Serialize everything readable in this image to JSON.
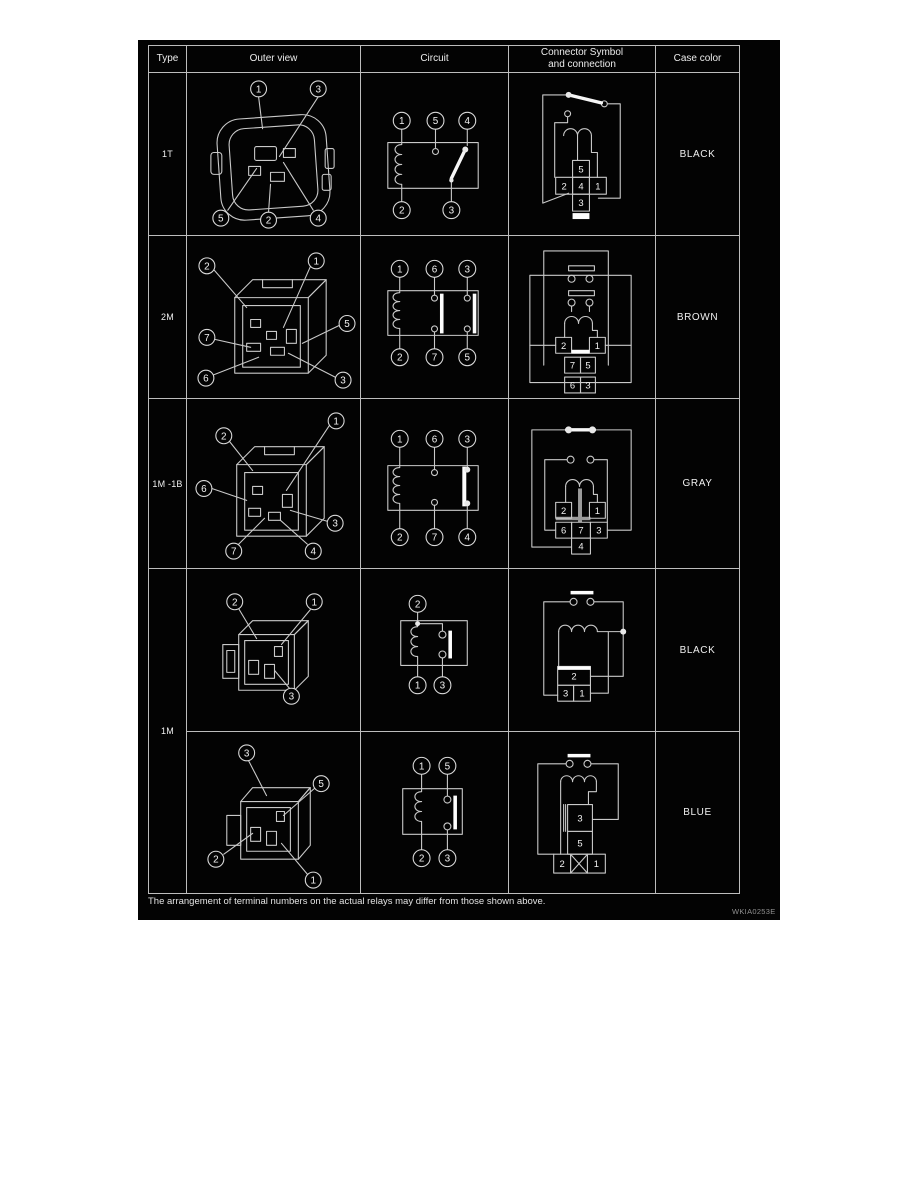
{
  "header": {
    "type": "Type",
    "outer_view": "Outer view",
    "circuit": "Circuit",
    "connector_line1": "Connector Symbol",
    "connector_line2": "and connection",
    "case_color": "Case color"
  },
  "rows": {
    "r1": {
      "type": "1T",
      "case_color": "BLACK",
      "outer": {
        "c1": "1",
        "c2": "3",
        "c3": "5",
        "c4": "2",
        "c5": "4"
      },
      "circuit": {
        "t1": "1",
        "t2": "5",
        "t3": "4",
        "b1": "2",
        "b2": "3"
      },
      "grid": {
        "top": "5",
        "m1": "2",
        "m2": "4",
        "m3": "1",
        "bottom": "3"
      }
    },
    "r2": {
      "type": "2M",
      "case_color": "BROWN",
      "outer": {
        "c1": "2",
        "c2": "1",
        "c3": "7",
        "c4": "5",
        "c5": "6",
        "c6": "3"
      },
      "circuit": {
        "t1": "1",
        "t2": "6",
        "t3": "3",
        "b1": "2",
        "b2": "7",
        "b3": "5"
      },
      "grid": {
        "a1": "2",
        "a2": "1",
        "b1": "7",
        "b2": "5",
        "c1": "6",
        "c2": "3"
      }
    },
    "r3": {
      "type": "1M -1B",
      "case_color": "GRAY",
      "outer": {
        "c1": "2",
        "c2": "1",
        "c3": "6",
        "c4": "3",
        "c5": "7",
        "c6": "4"
      },
      "circuit": {
        "t1": "1",
        "t2": "6",
        "t3": "3",
        "b1": "2",
        "b2": "7",
        "b3": "4"
      },
      "grid": {
        "a1": "2",
        "a2": "1",
        "b1": "6",
        "b2": "7",
        "b3": "3",
        "c1": "4"
      }
    },
    "r4": {
      "type": "1M",
      "case_color": "BLACK",
      "outer": {
        "c1": "2",
        "c2": "1",
        "c3": "3"
      },
      "circuit": {
        "t1": "2",
        "b1": "1",
        "b2": "3"
      },
      "grid": {
        "a1": "2",
        "b1": "3",
        "b2": "1"
      }
    },
    "r5": {
      "case_color": "BLUE",
      "outer": {
        "c1": "3",
        "c2": "5",
        "c3": "2",
        "c4": "1"
      },
      "circuit": {
        "t1": "1",
        "t2": "5",
        "b1": "2",
        "b2": "3"
      },
      "grid": {
        "a1": "3",
        "a2": "5",
        "b1": "2",
        "b2": "1"
      }
    }
  },
  "footer": {
    "note": "The arrangement of terminal numbers on the actual relays may differ from those shown above.",
    "code": "WKIA0253E"
  }
}
